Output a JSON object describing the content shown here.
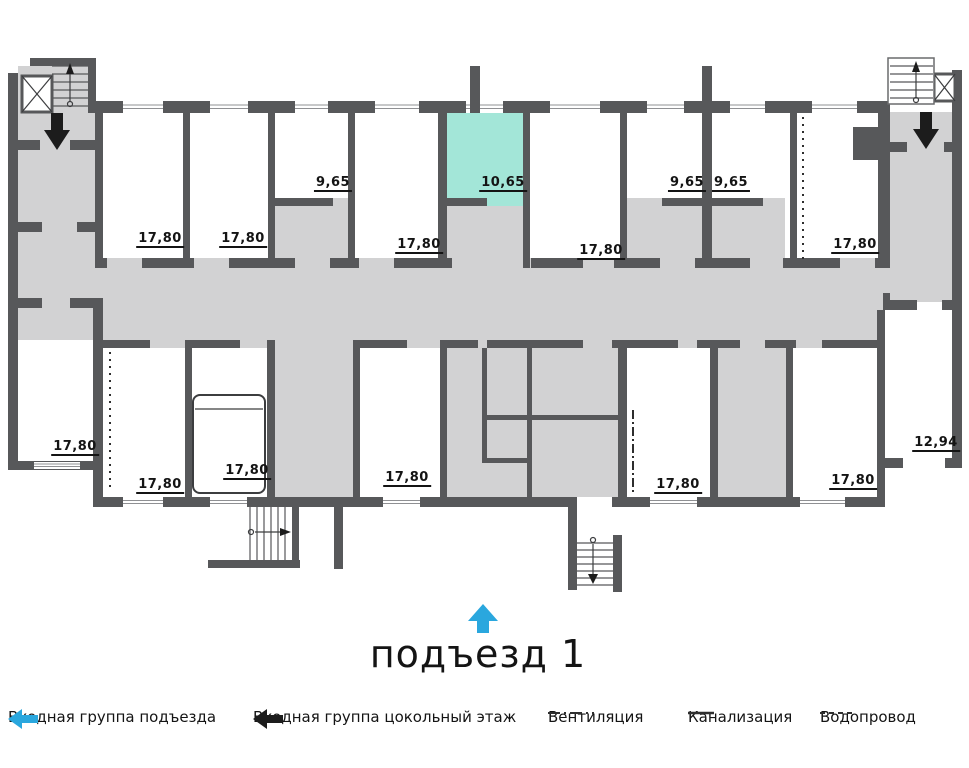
{
  "colors": {
    "wall": "#57585a",
    "floor": "#d2d2d3",
    "highlight": "#a3e6d8",
    "accent": "#2aa7de",
    "ink": "#141414"
  },
  "title": {
    "text": "подъезд 1"
  },
  "rooms": {
    "top": [
      {
        "id": "top-1",
        "area": "17,80"
      },
      {
        "id": "top-2",
        "area": "17,80"
      },
      {
        "id": "top-3",
        "area": "9,65"
      },
      {
        "id": "top-4",
        "area": "17,80"
      },
      {
        "id": "top-5",
        "area": "10,65",
        "highlighted": true
      },
      {
        "id": "top-6",
        "area": "17,80"
      },
      {
        "id": "top-7",
        "area": "9,65"
      },
      {
        "id": "top-8",
        "area": "9,65"
      },
      {
        "id": "top-9",
        "area": "17,80"
      }
    ],
    "bottom": [
      {
        "id": "bottom-1",
        "area": "17,80"
      },
      {
        "id": "bottom-2",
        "area": "17,80"
      },
      {
        "id": "bottom-3",
        "area": "17,80"
      },
      {
        "id": "bottom-4",
        "area": "17,80"
      },
      {
        "id": "bottom-5",
        "area": "17,80"
      },
      {
        "id": "bottom-6",
        "area": "17,80"
      },
      {
        "id": "bottom-7",
        "area": "12,94"
      }
    ]
  },
  "legend": {
    "items": [
      {
        "id": "entrance-main",
        "label": "Входная группа подъезда",
        "symbol": "arrow-left-cyan"
      },
      {
        "id": "entrance-basement",
        "label": "Входная группа цокольный этаж",
        "symbol": "arrow-left-black"
      },
      {
        "id": "ventilation",
        "label": "Вентиляция",
        "symbol": "dash-dot-line"
      },
      {
        "id": "sewerage",
        "label": "Канализация",
        "symbol": "solid-line"
      },
      {
        "id": "water",
        "label": "Водопровод",
        "symbol": "dashed-line"
      }
    ]
  }
}
